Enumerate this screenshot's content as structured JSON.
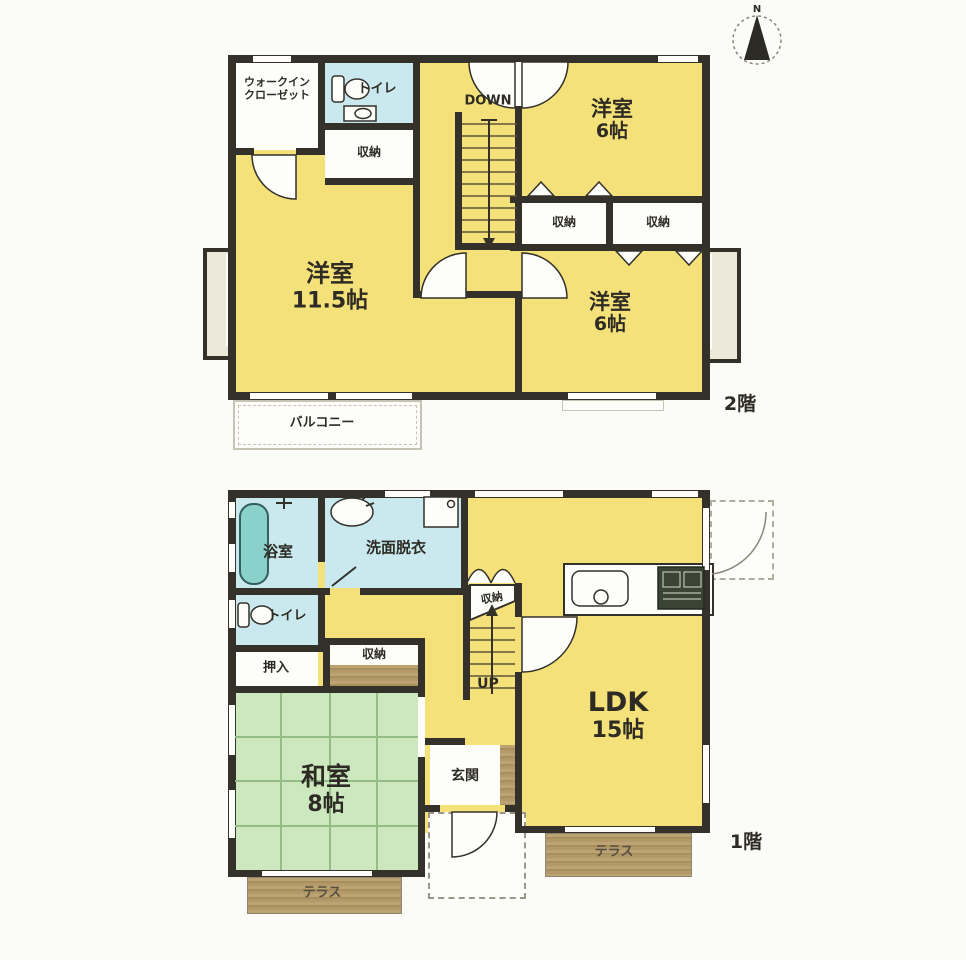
{
  "compass": {
    "north": "N"
  },
  "floor2": {
    "floor_label": "2階",
    "walk_in_closet_line1": "ウォークイン",
    "walk_in_closet_line2": "クローゼット",
    "toilet": "トイレ",
    "storage": "収納",
    "stairs_direction": "DOWN",
    "bedroom_ne": {
      "name": "洋室",
      "size": "6帖"
    },
    "bedroom_main": {
      "name": "洋室",
      "size": "11.5帖"
    },
    "bedroom_se": {
      "name": "洋室",
      "size": "6帖"
    },
    "balcony": "バルコニー"
  },
  "floor1": {
    "floor_label": "1階",
    "bath": "浴室",
    "washroom": "洗面脱衣",
    "toilet": "トイレ",
    "oshiire": "押入",
    "storage": "収納",
    "stair_storage": "収納",
    "stairs_direction": "UP",
    "ldk": {
      "name": "LDK",
      "size": "15帖"
    },
    "washitsu": {
      "name": "和室",
      "size": "8帖"
    },
    "genkan": "玄関",
    "terrace_south": "テラス",
    "terrace_east": "テラス"
  },
  "colors": {
    "room_yellow": "#f5e17a",
    "room_blue": "#c9e9ef",
    "room_green": "#cde8bf",
    "terrace_brown": "#b49a6a",
    "wall": "#34312a",
    "bathtub_teal": "#8ad1cb"
  }
}
